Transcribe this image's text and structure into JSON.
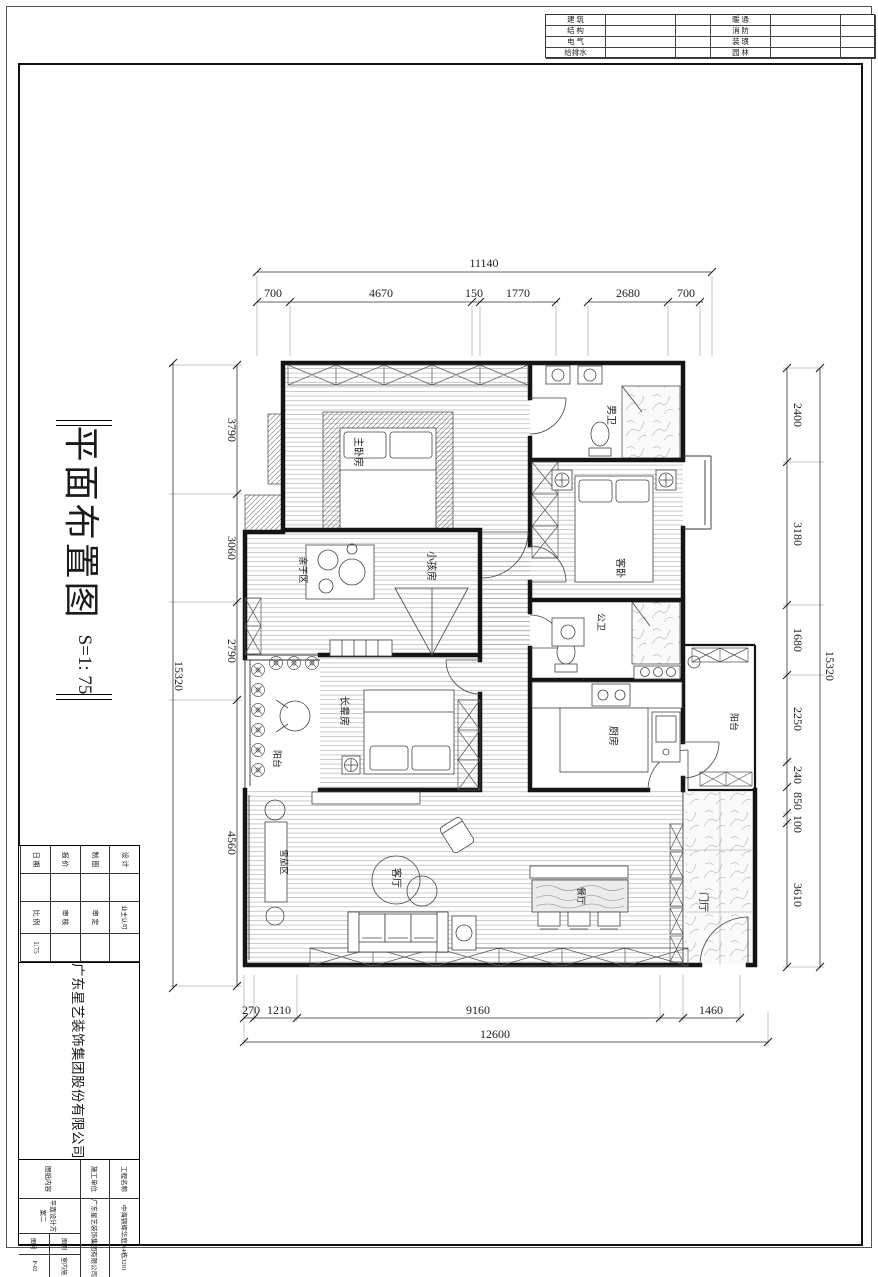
{
  "header_table": {
    "left_rows": [
      "建 筑",
      "结 构",
      "电 气",
      "给排水"
    ],
    "right_rows": [
      "暖 通",
      "消 防",
      "装 璜",
      "园 林"
    ]
  },
  "sheet_title": {
    "text": "平面布置图",
    "scale": "S=1: 75"
  },
  "title_block": {
    "company": "广东星艺装饰集团股份有限公司",
    "cert_note": "施工图审查证书编号：A144016621(甲级)",
    "col1": [
      {
        "label": "设 计"
      },
      {
        "label": "制 图"
      },
      {
        "label": "报 价"
      },
      {
        "label": "日 期"
      }
    ],
    "col2": [
      {
        "label": "业主认可",
        "value": ""
      },
      {
        "label": "审 定",
        "value": ""
      },
      {
        "label": "审 核",
        "value": ""
      },
      {
        "label": "比 例",
        "value": "1:75"
      }
    ],
    "project_label": "工程名称",
    "project_value": "中海锦辉华庭A4栋3201",
    "builder_label": "施工单位",
    "builder_value": "广东星艺装饰集团有限公司",
    "content_label": "图纸内容",
    "content_value": "平面设计方案二",
    "cat_label": "图别",
    "cat_value": "室内施",
    "no_label": "图号",
    "no_value": "P-02"
  },
  "dims": {
    "top": {
      "overall": "11140",
      "segments": [
        "700",
        "4670",
        "150",
        "1770",
        "2680",
        "700"
      ]
    },
    "bottom": {
      "overall": "12600",
      "segments": [
        "270",
        "1210",
        "9160",
        "1460"
      ]
    },
    "left": {
      "overall": "15320",
      "segments": [
        "3790",
        "3060",
        "2790",
        "4560"
      ]
    },
    "right": {
      "overall": "15320",
      "segments": [
        "2400",
        "3180",
        "1680",
        "2250",
        "240",
        "850",
        "100",
        "3610"
      ]
    }
  },
  "rooms": {
    "master": "主卧房",
    "men_bath": "男卫",
    "guest": "客卧",
    "kids": "小孩房",
    "family": "亲子区",
    "pub_bath": "公卫",
    "elder": "长辈房",
    "balcony_l": "阳台",
    "kitchen": "厨房",
    "balcony_r": "阳台",
    "living": "客厅",
    "dining": "餐厅",
    "foyer": "门厅",
    "cigar": "雪茄区"
  }
}
